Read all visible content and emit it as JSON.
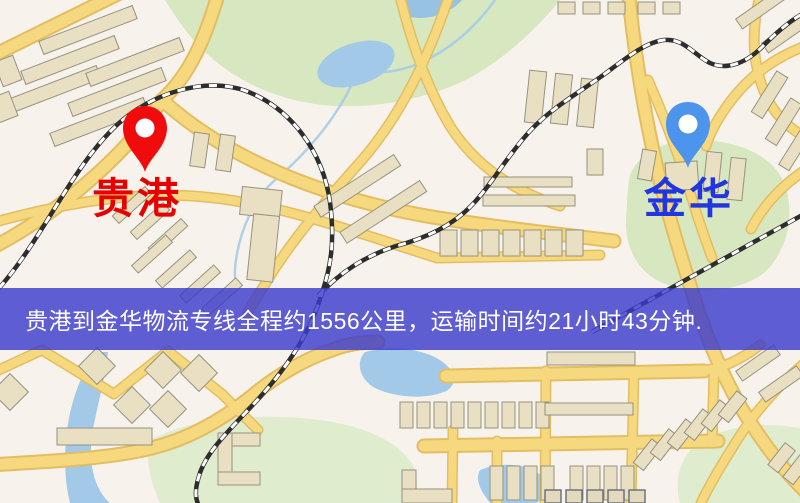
{
  "map": {
    "origin": {
      "label": "贵港",
      "pin_icon": "map-pin-icon",
      "pin_color": "#f00c0c",
      "label_color": "#e60000"
    },
    "destination": {
      "label": "金华",
      "pin_icon": "map-pin-icon",
      "pin_color": "#4d94ec",
      "label_color": "#2135e0"
    }
  },
  "banner": {
    "text": "贵港到金华物流专线全程约1556公里，运输时间约21小时43分钟.",
    "background_color": "#3c3ccc",
    "text_color": "#ffffff"
  },
  "colors": {
    "origin_pin": "#f00c0c",
    "origin_label": "#e60000",
    "destination_pin": "#4d94ec",
    "destination_label": "#2135e0",
    "banner_bg": "#3c3ccc",
    "banner_text": "#ffffff",
    "map_bg": "#f7f3ec",
    "road": "#f6d97e",
    "road_casing": "#e3bd62",
    "park": "#d7e7c0",
    "water": "#a3c9e8",
    "building": "#e9e0c4",
    "railway": "#2d2d2d"
  }
}
